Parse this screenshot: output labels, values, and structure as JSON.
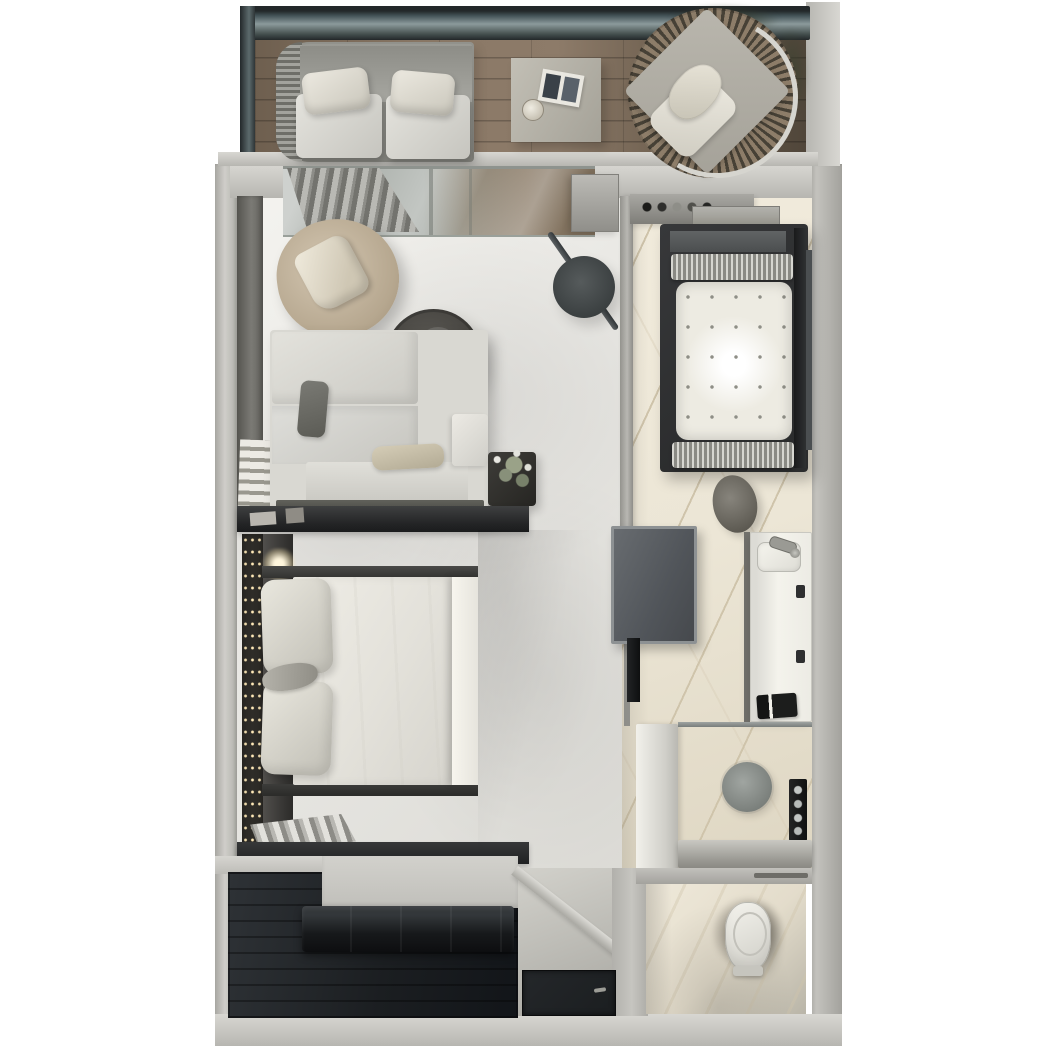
{
  "scene": {
    "kind": "3d-floor-plan-top-down-render",
    "subject": "hotel-suite-with-balcony-and-bathroom",
    "canvas": {
      "width": 1054,
      "height": 1056
    },
    "background": "#ffffff",
    "text_labels": []
  },
  "palette": {
    "bg": "#ffffff",
    "wall": "#b7b6b1",
    "wall_light": "#d8d7d2",
    "wall_dark": "#8f8e89",
    "floor": "#e9e8e4",
    "marble": "#ece6d6",
    "marble_vein": "#cfc4ab",
    "wood": "#85735f",
    "wood_dark": "#5e5142",
    "dark_wood": "#1b1e21",
    "railing": "#34393b",
    "glass": "#9aa4a4",
    "sofa": "#d9d8d2",
    "cushion": "#e7e4db",
    "beige": "#c2b39d",
    "charcoal": "#4f4d49",
    "tub_frame": "#2b2c2d",
    "panel": "#5d6165",
    "metal": "#9a9a94",
    "led": "#ffe9b8",
    "leather": "#17191b",
    "plant": "#7d8570",
    "mat": "#1b1e20"
  },
  "rooms": [
    {
      "id": "balcony",
      "name": "balcony-terrace"
    },
    {
      "id": "living",
      "name": "living-area"
    },
    {
      "id": "bedroom",
      "name": "bedroom-area"
    },
    {
      "id": "bathroom",
      "name": "bathroom"
    },
    {
      "id": "shower",
      "name": "shower-room"
    },
    {
      "id": "wc",
      "name": "toilet-room"
    },
    {
      "id": "entry",
      "name": "entry-hall-and-wardrobe"
    }
  ],
  "furniture": [
    {
      "room": "balcony",
      "items": [
        "glass-railing",
        "daybed",
        "daybed-cushions",
        "daybed-pillows",
        "side-table",
        "magazine",
        "cup",
        "hanging-fan-chair",
        "chair-cushion",
        "chair-pillow",
        "foliage"
      ]
    },
    {
      "room": "living",
      "items": [
        "sheer-curtains",
        "wall-ledge-shelf",
        "lounge-armchair",
        "armchair-cushion",
        "round-coffee-table",
        "decor-tray",
        "corner-sofa",
        "dark-accent-pillow",
        "beige-accent-pillow",
        "floor-plant",
        "arc-floor-lamp",
        "minibar-cabinet",
        "sliding-glass-door"
      ]
    },
    {
      "room": "bedroom",
      "items": [
        "king-bed",
        "pillows",
        "bed-throw",
        "led-backlit-headboard",
        "bedside-lamp-glow",
        "console-top",
        "console-bottom",
        "pleated-curtain",
        "wall-mounted-tv"
      ]
    },
    {
      "room": "bathroom",
      "items": [
        "amenity-shelf",
        "toiletry-bottles",
        "bath-tray",
        "jacuzzi-bathtub",
        "tub-headrests",
        "tub-jets",
        "towel-rail",
        "vanity-counter",
        "sink-faucet",
        "vanity-stool",
        "rolled-towels",
        "drawer-pulls"
      ]
    },
    {
      "room": "shower",
      "items": [
        "rain-shower-head",
        "shower-control-panel",
        "shower-bench",
        "glass-screen",
        "partition-wall"
      ]
    },
    {
      "room": "wc",
      "items": [
        "toilet",
        "towel-bar"
      ]
    },
    {
      "room": "entry",
      "items": [
        "dark-wood-wardrobe-floor",
        "leather-bench",
        "door-mat",
        "door-handle",
        "angled-corridor-wall"
      ]
    }
  ]
}
